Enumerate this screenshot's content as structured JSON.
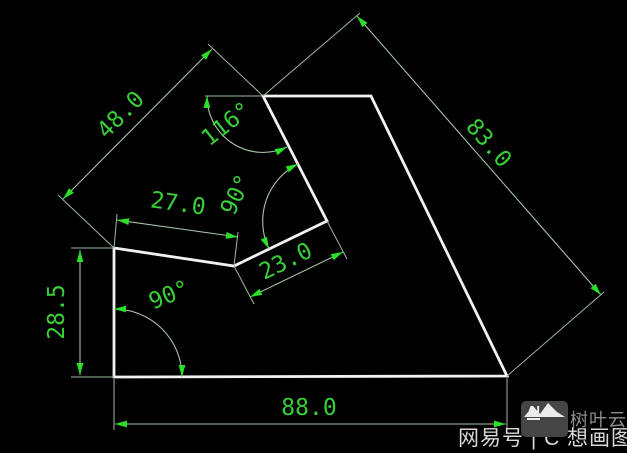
{
  "drawing": {
    "dimensions": {
      "dim48": "48.0",
      "dim83": "83.0",
      "dim27": "27.0",
      "dim23": "23.0",
      "dim285": "28.5",
      "dim88": "88.0"
    },
    "angles": {
      "angle116": "116°",
      "angle90_notch": "90°",
      "angle90_corner": "90°"
    },
    "colors": {
      "background": "#000000",
      "shape_outline": "#f2f2f2",
      "dimension_line": "#a6c4a6",
      "dimension_text": "#38cf38",
      "arrow": "#2ae02a"
    }
  },
  "watermark": {
    "left_text": "网易号 | C",
    "right_text": "想画图",
    "logo_label": "AI",
    "brand": "树叶云"
  }
}
